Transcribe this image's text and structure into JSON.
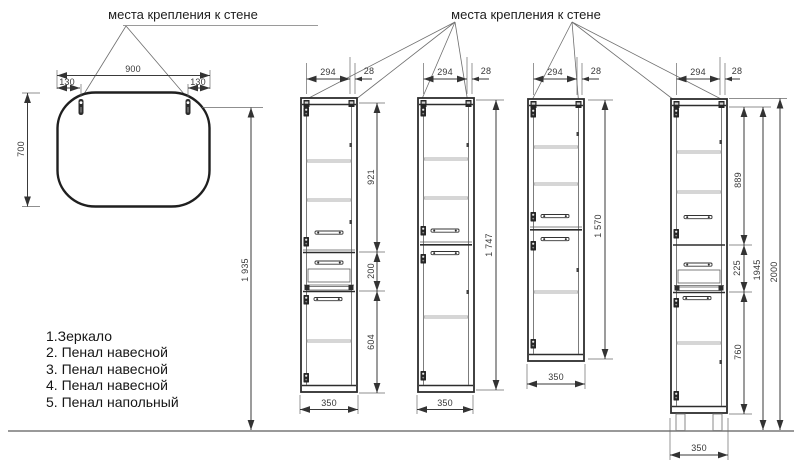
{
  "annotations": {
    "left_wall_mount_label": "места крепления к стене",
    "right_wall_mount_label": "места крепления к стене"
  },
  "legend": {
    "items": [
      "1.Зеркало",
      "2. Пенал навесной",
      "3. Пенал навесной",
      "4. Пенал навесной",
      "5. Пенал напольный"
    ]
  },
  "mirror": {
    "dims": {
      "width": "900",
      "left_hook_offset": "130",
      "right_hook_offset": "130",
      "height": "700",
      "mount_height": "1 935"
    }
  },
  "cabinets": [
    {
      "legend_ref": "2",
      "type": "Пенал навесной",
      "dims": {
        "door_width": "294",
        "side_gap": "28",
        "upper_section": "921",
        "drawer_section": "200",
        "lower_section": "604",
        "width": "350"
      }
    },
    {
      "legend_ref": "3",
      "type": "Пенал навесной",
      "dims": {
        "door_width": "294",
        "side_gap": "28",
        "height": "1 747",
        "width": "350"
      }
    },
    {
      "legend_ref": "4",
      "type": "Пенал навесной",
      "dims": {
        "door_width": "294",
        "side_gap": "28",
        "height": "1 570",
        "width": "350"
      }
    },
    {
      "legend_ref": "5",
      "type": "Пенал напольный",
      "dims": {
        "door_width": "294",
        "side_gap": "28",
        "upper_section": "889",
        "drawer_section": "225",
        "lower_section": "760",
        "body_height": "1945",
        "total_height": "2000",
        "width": "350"
      }
    }
  ],
  "colors": {
    "ink": "#2d2d2d",
    "floor_line": "#999999",
    "dimension_text": "#383838"
  }
}
